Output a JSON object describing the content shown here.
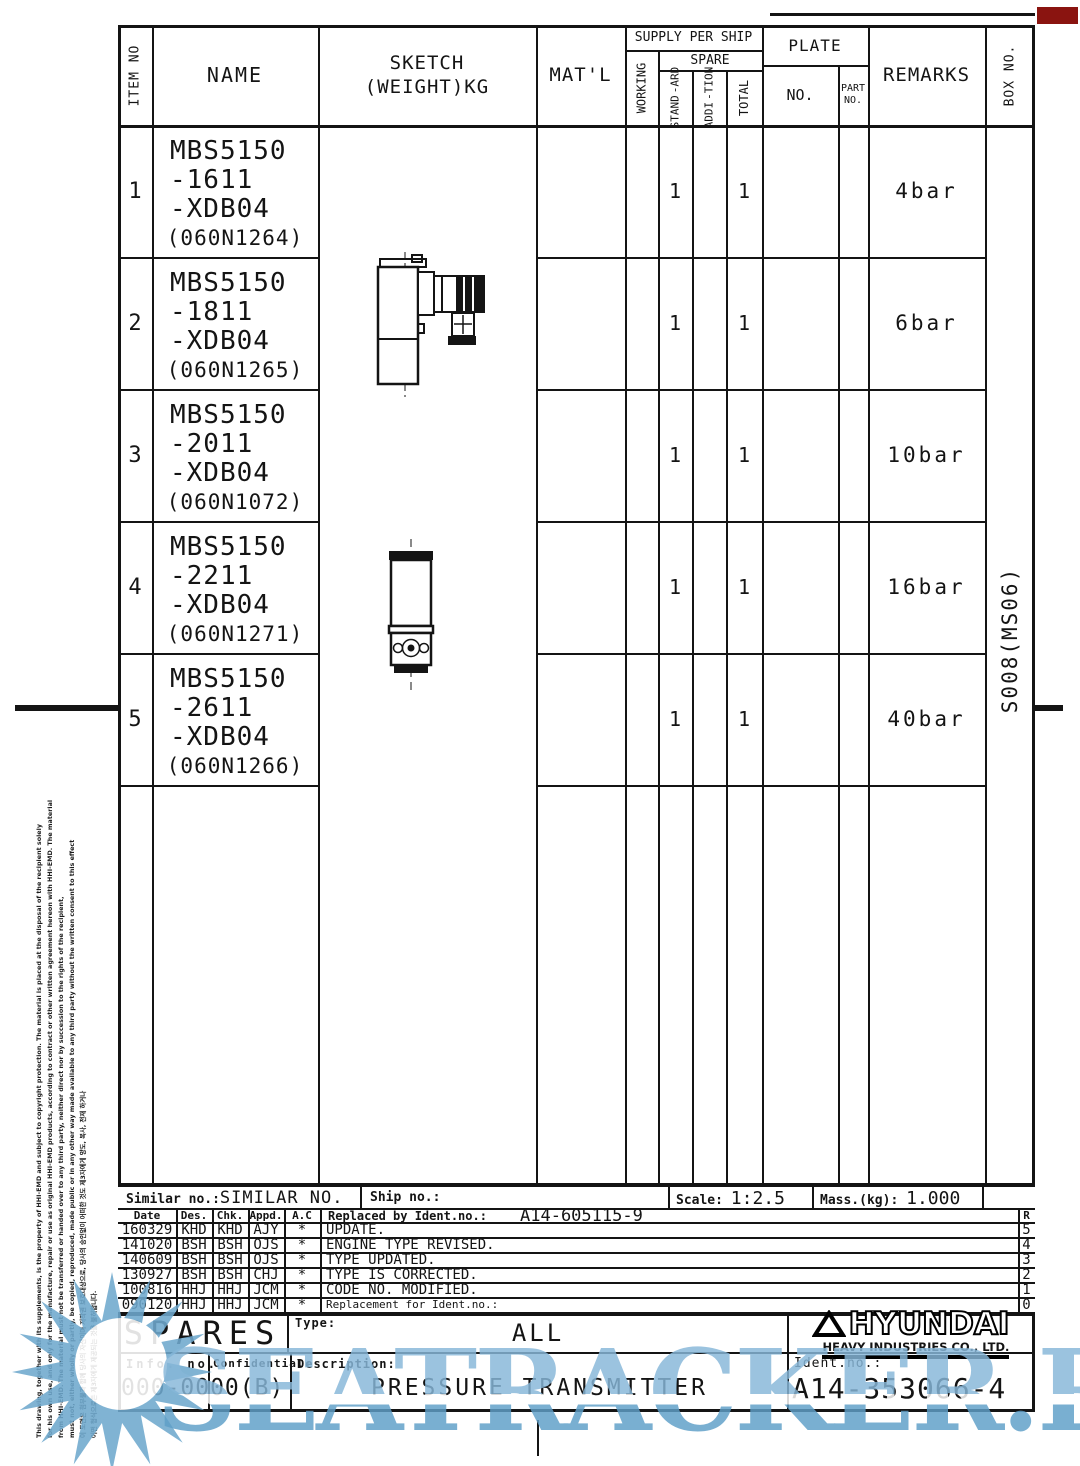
{
  "table": {
    "headers": {
      "item_no": "ITEM NO",
      "name": "NAME",
      "sketch_1": "SKETCH",
      "sketch_2": "(WEIGHT)KG",
      "matl": "MAT'L",
      "supply": "SUPPLY PER SHIP",
      "working": "WORKING",
      "spare": "SPARE",
      "standard_1": "STAND",
      "standard_2": "-ARD",
      "addition_1": "ADDI",
      "addition_2": "-TION",
      "total": "TOTAL",
      "plate": "PLATE",
      "plate_no": "NO.",
      "part_no_1": "PART",
      "part_no_2": "NO.",
      "remarks": "REMARKS",
      "box_no": "BOX NO."
    },
    "rows": [
      {
        "item": "1",
        "name_1": "MBS5150",
        "name_2": "-1611",
        "name_3": "-XDB04",
        "code": "(060N1264)",
        "standard": "1",
        "total": "1",
        "remarks": "4bar"
      },
      {
        "item": "2",
        "name_1": "MBS5150",
        "name_2": "-1811",
        "name_3": "-XDB04",
        "code": "(060N1265)",
        "standard": "1",
        "total": "1",
        "remarks": "6bar"
      },
      {
        "item": "3",
        "name_1": "MBS5150",
        "name_2": "-2011",
        "name_3": "-XDB04",
        "code": "(060N1072)",
        "standard": "1",
        "total": "1",
        "remarks": "10bar"
      },
      {
        "item": "4",
        "name_1": "MBS5150",
        "name_2": "-2211",
        "name_3": "-XDB04",
        "code": "(060N1271)",
        "standard": "1",
        "total": "1",
        "remarks": "16bar"
      },
      {
        "item": "5",
        "name_1": "MBS5150",
        "name_2": "-2611",
        "name_3": "-XDB04",
        "code": "(060N1266)",
        "standard": "1",
        "total": "1",
        "remarks": "40bar"
      }
    ],
    "box_no_value": "S008(MS06)"
  },
  "info_strip": {
    "similar_label": "Similar no.:",
    "similar_value": "SIMILAR NO.",
    "ship_label": "Ship no.:",
    "scale_label": "Scale:",
    "scale_value": "1:2.5",
    "mass_label": "Mass.(kg):",
    "mass_value": "1.000"
  },
  "revisions": {
    "col_date": "Date",
    "col_des": "Des.",
    "col_chk": "Chk.",
    "col_appd": "Appd.",
    "col_ac": "A.C",
    "replaced_label": "Replaced by Ident.no.:",
    "replaced_value": "A14-605115-9",
    "r_label": "R",
    "rows": [
      {
        "date": "160329",
        "des": "KHD",
        "chk": "KHD",
        "appd": "AJY",
        "ac": "*",
        "desc": "UPDATE.",
        "rev": "5"
      },
      {
        "date": "141020",
        "des": "BSH",
        "chk": "BSH",
        "appd": "OJS",
        "ac": "*",
        "desc": "ENGINE TYPE REVISED.",
        "rev": "4"
      },
      {
        "date": "140609",
        "des": "BSH",
        "chk": "BSH",
        "appd": "OJS",
        "ac": "*",
        "desc": "TYPE UPDATED.",
        "rev": "3"
      },
      {
        "date": "130927",
        "des": "BSH",
        "chk": "BSH",
        "appd": "CHJ",
        "ac": "*",
        "desc": "TYPE IS CORRECTED.",
        "rev": "2"
      },
      {
        "date": "100816",
        "des": "HHJ",
        "chk": "HHJ",
        "appd": "JCM",
        "ac": "*",
        "desc": "CODE NO. MODIFIED.",
        "rev": "1"
      },
      {
        "date": "090120",
        "des": "HHJ",
        "chk": "HHJ",
        "appd": "JCM",
        "ac": "*",
        "desc": "Replacement for Ident.no.:",
        "rev": "0"
      }
    ]
  },
  "title_block": {
    "spares": "SPARES",
    "type_label": "Type:",
    "type_value": "ALL",
    "info_no_label": "Info. no.",
    "info_no_value": "000-0000(B)",
    "confidential_label": "Confidential:",
    "description_label": "Description:",
    "description_value": "PRESSURE TRANSMITTER",
    "ident_label": "Ident.no.:",
    "ident_value": "A14-353066-4",
    "logo_name": "HYUNDAI",
    "logo_sub": "HEAVY INDUSTRIES CO., LTD."
  },
  "disclaimer": {
    "lines": [
      "This drawing, together with its supplements, is the property of HHI-EMD and subject to copyright protection. The material is placed at the disposal of the recipient solely",
      "for his own use, and only for the manufacture, repair or use as original HHI-EMD products, according to contract or other written agreement hereon with HHI-EMD. The material",
      "from HHI-EMD. The material must not be transferred or handed over to any third party, neither direct nor by succession to the rights of the recipient,",
      "must not, either wholly or partly, be copied, reproduced, made public or in any other way made available to any third party without the written consent to this effect",
      "이 도면은 첨부물과 함께 당사의 자산이며 저작권 보호대상으로, 당사의 승인없이 어떠한 것도 제3자에게 양도, 복사, 전재 하거나",
      "어떤 형식으로든 제3자에게 제공되는 것을 불허합니다."
    ]
  },
  "watermark": {
    "text": "SEATRACKER.RU",
    "color": "#6FA9CE"
  },
  "marks": {
    "corner_red": "#8A1410"
  }
}
